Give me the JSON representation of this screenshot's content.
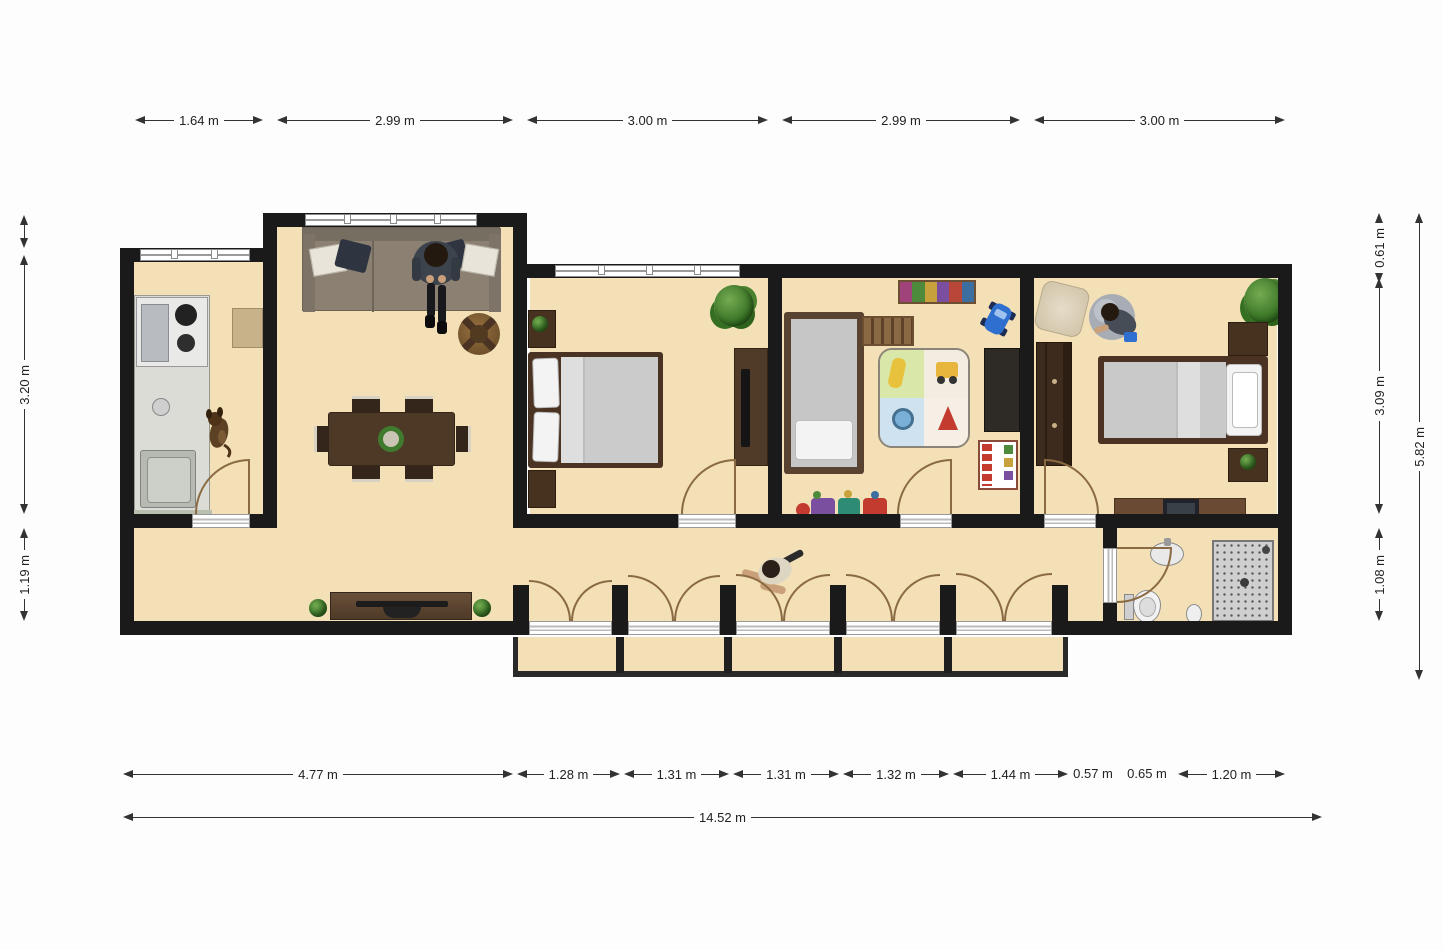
{
  "colors": {
    "floor": "#f3e0b6",
    "wall": "#1a1a1a",
    "dim": "#222222",
    "arc": "#8a6a42",
    "wood": "#4a3424",
    "bg": "#fdfdfd"
  },
  "dimensions": {
    "top": [
      "1.64 m",
      "2.99 m",
      "3.00 m",
      "2.99 m",
      "3.00 m"
    ],
    "left": [
      "3.20 m",
      "1.19 m"
    ],
    "right": [
      "0.61 m",
      "3.09 m",
      "1.08 m"
    ],
    "right_total": "5.82 m",
    "bottom": [
      "4.77 m",
      "1.28 m",
      "1.31 m",
      "1.31 m",
      "1.32 m",
      "1.44 m",
      "0.57 m",
      "0.65 m",
      "1.20 m"
    ],
    "bottom_total": "14.52 m"
  }
}
